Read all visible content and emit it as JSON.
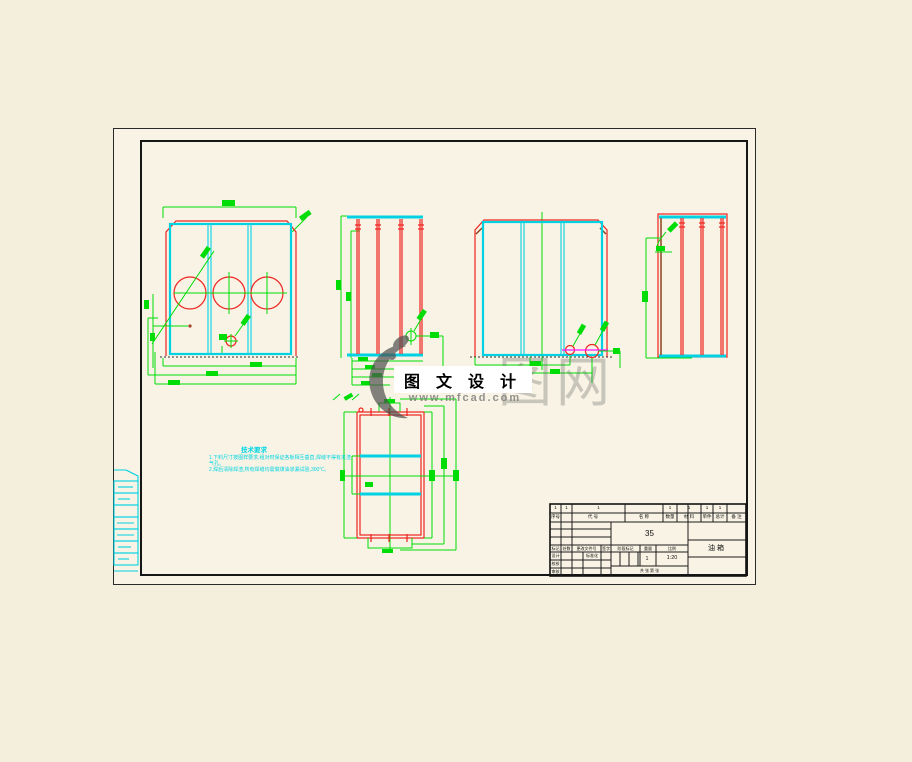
{
  "colors": {
    "cyan": "#00d2e4",
    "red": "#f02420",
    "green": "#00dd06",
    "magenta": "#ff10ff",
    "sheet_bg": "#f8f3e4",
    "page_bg": "#f4eedd"
  },
  "watermark": {
    "title": "图 文 设 计",
    "url": "www.mfcad.com",
    "ghost_text": "图网",
    "logo_icon": "mfcad-crescent-logo"
  },
  "notes": {
    "heading": "技术要求",
    "line1": "1.下料尺寸按图样要求,组对时保证各板相互垂直,焊缝不得有夹渣",
    "line2": "气孔。",
    "line3": "2.焊后清除焊渣,所有焊缝均需做煤油渗漏试验,300℃。"
  },
  "title_block": {
    "bom": {
      "headers": [
        "序号",
        "代 号",
        "名 称",
        "数量",
        "材 料",
        "单件",
        "总计",
        "备 注"
      ],
      "quantities": [
        "1",
        "1",
        "1",
        "1",
        "1",
        "1",
        "1"
      ]
    },
    "material": "35",
    "part_name": "油箱",
    "rev_row": [
      "标记",
      "处数",
      "更改文件号",
      "签字"
    ],
    "sign_rows": [
      "设计",
      "校核",
      "审核"
    ],
    "std_label": "标准化",
    "stage_label": "阶段标记",
    "weight_label": "重量",
    "scale_label": "比例",
    "weight_value": "1",
    "scale_value": "1:20",
    "sheet_label": "共 张 第 张"
  }
}
